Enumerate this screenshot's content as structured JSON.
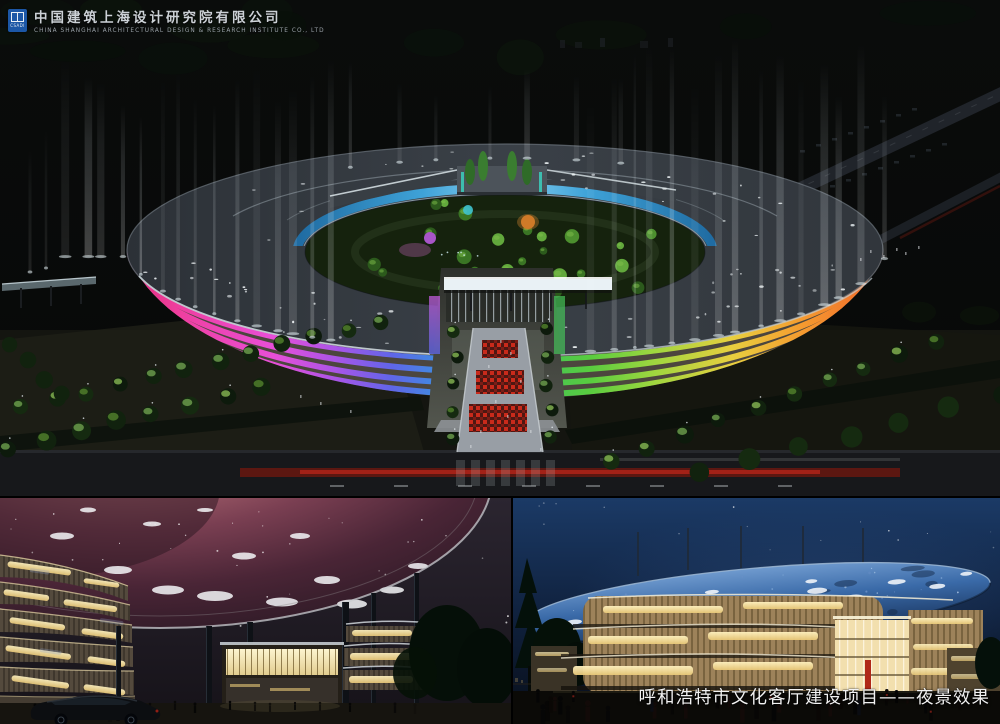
{
  "header": {
    "logo_acronym": "CSADI",
    "company_cn": "中国建筑上海设计研究院有限公司",
    "company_en": "CHINA SHANGHAI ARCHITECTURAL DESIGN & RESEARCH INSTITUTE CO., LTD"
  },
  "caption": {
    "text": "呼和浩特市文化客厅建设项目——夜景效果"
  },
  "colors": {
    "logo_blue": "#1c57a6",
    "caption_text": "#f2f2f2",
    "facade_left_accent": "#ef3f9f",
    "facade_right_accent": "#f59a2f",
    "inner_ring_glass": "#3fa8e0",
    "nebula_canopy": "#8a4a58",
    "starry_disc": "#3a6aa8",
    "window_gold": "#f0dc9e"
  }
}
